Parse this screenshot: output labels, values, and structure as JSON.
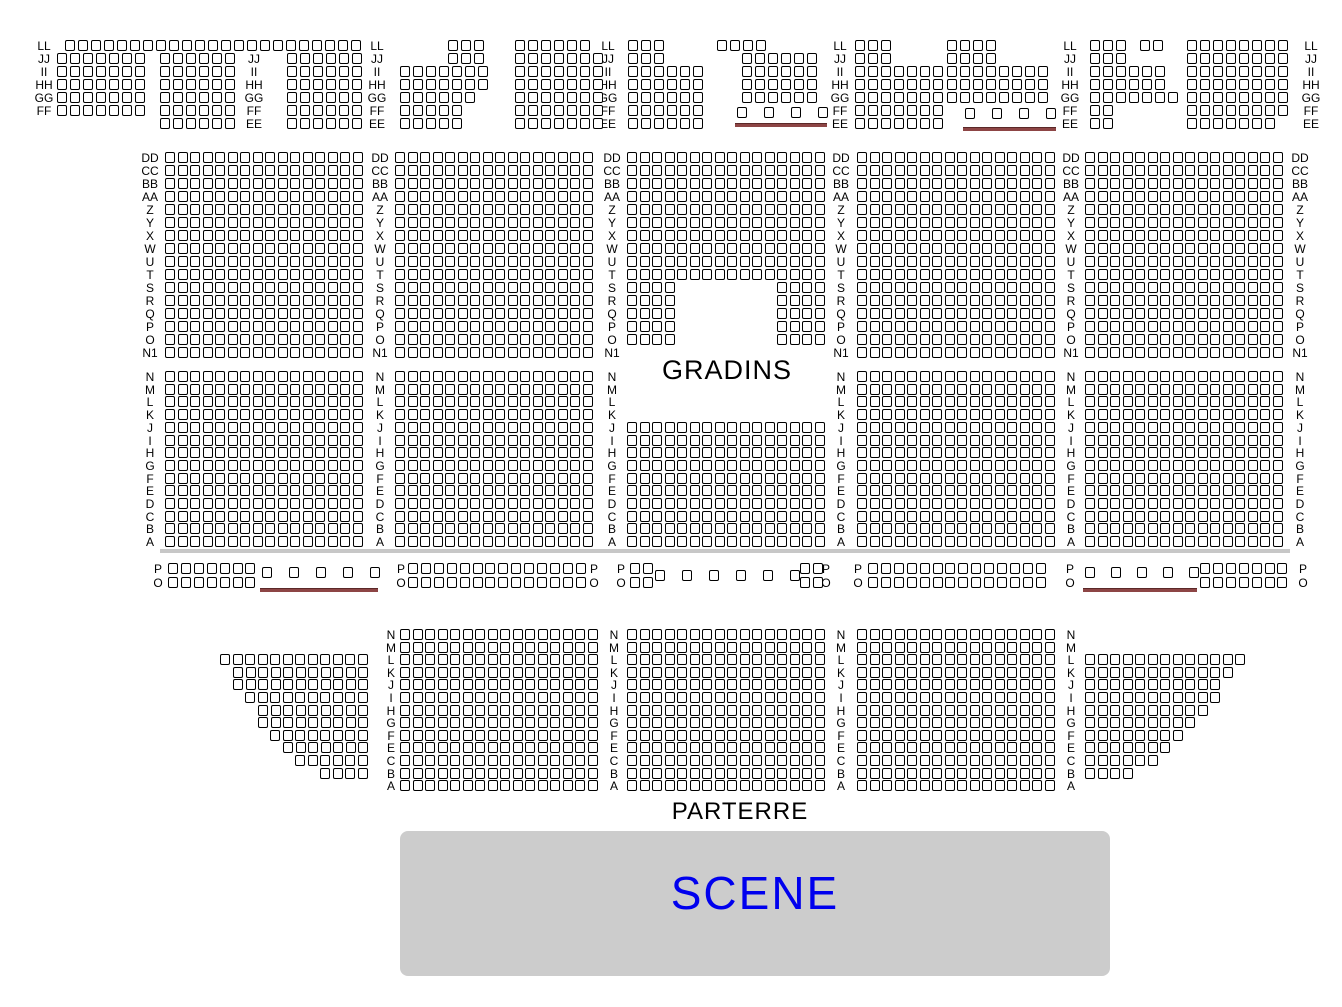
{
  "texts": {
    "gradins": "GRADINS",
    "parterre": "PARTERRE",
    "scene": "SCENE"
  },
  "colors": {
    "background": "#ffffff",
    "seat_fill": "#ffffff",
    "seat_border": "#000000",
    "row_label": "#000000",
    "zone_text": "#000000",
    "wheelchair_bar": "#8d4545",
    "wheelchair_bar_edge": "#5a2828",
    "aisle_bar": "#c7c7c7",
    "stage_fill": "#cccccc",
    "stage_text": "#0000ee"
  },
  "seatmap": {
    "aisle": {
      "x": 160,
      "y": 549,
      "w": 1130,
      "h": 4
    },
    "sections": [
      {
        "name": "balcony",
        "y0": 40,
        "pitchX": 13,
        "pitchY": 13,
        "rowLabels": [
          "LL",
          "JJ",
          "II",
          "HH",
          "GG",
          "FF",
          "EE"
        ],
        "labelCols": [
          {
            "x": 44,
            "from": 0,
            "to": 5
          },
          {
            "x": 254,
            "from": 1,
            "to": 6
          },
          {
            "x": 377,
            "from": 0,
            "to": 6
          },
          {
            "x": 608,
            "from": 0,
            "to": 6
          },
          {
            "x": 840,
            "from": 0,
            "to": 6
          },
          {
            "x": 1070,
            "from": 0,
            "to": 6
          },
          {
            "x": 1311,
            "from": 0,
            "to": 6
          }
        ],
        "runs": [
          [
            0,
            65,
            23
          ],
          [
            0,
            448,
            3
          ],
          [
            0,
            515,
            6
          ],
          [
            0,
            628,
            3
          ],
          [
            0,
            717,
            4
          ],
          [
            0,
            855,
            3
          ],
          [
            0,
            947,
            4
          ],
          [
            0,
            1090,
            3
          ],
          [
            0,
            1140,
            2
          ],
          [
            0,
            1187,
            8
          ],
          [
            1,
            57,
            7
          ],
          [
            2,
            57,
            7
          ],
          [
            3,
            57,
            7
          ],
          [
            4,
            57,
            7
          ],
          [
            5,
            57,
            7
          ],
          [
            1,
            160,
            6
          ],
          [
            2,
            160,
            6
          ],
          [
            3,
            160,
            6
          ],
          [
            4,
            160,
            6
          ],
          [
            5,
            160,
            6
          ],
          [
            6,
            160,
            6
          ],
          [
            1,
            287,
            6
          ],
          [
            2,
            287,
            6
          ],
          [
            3,
            287,
            6
          ],
          [
            4,
            287,
            6
          ],
          [
            5,
            287,
            6
          ],
          [
            6,
            287,
            6
          ],
          [
            1,
            448,
            3
          ],
          [
            2,
            400,
            7
          ],
          [
            3,
            400,
            7
          ],
          [
            4,
            400,
            6
          ],
          [
            5,
            400,
            5
          ],
          [
            6,
            400,
            5
          ],
          [
            1,
            515,
            7
          ],
          [
            2,
            515,
            7
          ],
          [
            3,
            515,
            7
          ],
          [
            4,
            515,
            7
          ],
          [
            5,
            515,
            7
          ],
          [
            6,
            515,
            7
          ],
          [
            1,
            628,
            3
          ],
          [
            2,
            628,
            6
          ],
          [
            3,
            628,
            6
          ],
          [
            4,
            628,
            6
          ],
          [
            5,
            628,
            6
          ],
          [
            6,
            628,
            6
          ],
          [
            1,
            742,
            6
          ],
          [
            2,
            742,
            6
          ],
          [
            3,
            742,
            6
          ],
          [
            4,
            742,
            6
          ],
          [
            1,
            855,
            3
          ],
          [
            2,
            855,
            7
          ],
          [
            3,
            855,
            7
          ],
          [
            4,
            855,
            7
          ],
          [
            5,
            855,
            7
          ],
          [
            6,
            855,
            7
          ],
          [
            1,
            947,
            4
          ],
          [
            2,
            947,
            8
          ],
          [
            3,
            947,
            8
          ],
          [
            4,
            947,
            8
          ],
          [
            1,
            1090,
            3
          ],
          [
            2,
            1090,
            6
          ],
          [
            3,
            1090,
            6
          ],
          [
            4,
            1090,
            7
          ],
          [
            5,
            1090,
            2
          ],
          [
            6,
            1090,
            2
          ],
          [
            1,
            1187,
            8
          ],
          [
            2,
            1187,
            8
          ],
          [
            3,
            1187,
            8
          ],
          [
            4,
            1187,
            8
          ],
          [
            5,
            1187,
            8
          ],
          [
            6,
            1187,
            7
          ]
        ],
        "singles": [
          [
            737,
            107
          ],
          [
            764,
            107
          ],
          [
            791,
            107
          ],
          [
            818,
            107
          ],
          [
            965,
            108
          ],
          [
            992,
            108
          ],
          [
            1019,
            108
          ],
          [
            1046,
            108
          ]
        ],
        "bars": [
          [
            735,
            123,
            92
          ],
          [
            963,
            127,
            93
          ]
        ]
      },
      {
        "name": "gradins-upper",
        "y0": 152,
        "pitchX": 12.5,
        "pitchY": 13,
        "rowLabels": [
          "DD",
          "CC",
          "BB",
          "AA",
          "Z",
          "Y",
          "X",
          "W",
          "U",
          "T",
          "S",
          "R",
          "Q",
          "P",
          "O",
          "N1"
        ],
        "labelCols": [
          {
            "x": 150,
            "from": 0,
            "to": 15
          },
          {
            "x": 380,
            "from": 0,
            "to": 15
          },
          {
            "x": 612,
            "from": 0,
            "to": 15
          },
          {
            "x": 841,
            "from": 0,
            "to": 15
          },
          {
            "x": 1071,
            "from": 0,
            "to": 15
          },
          {
            "x": 1300,
            "from": 0,
            "to": 15
          }
        ],
        "blocks": [
          {
            "x": 165,
            "row0": 0,
            "nrows": 16,
            "ncols": 16
          },
          {
            "x": 395,
            "row0": 0,
            "nrows": 16,
            "ncols": 16
          },
          {
            "x": 857,
            "row0": 0,
            "nrows": 16,
            "ncols": 16
          },
          {
            "x": 1085,
            "row0": 0,
            "nrows": 16,
            "ncols": 16
          }
        ],
        "runs": [
          [
            0,
            627,
            16
          ],
          [
            1,
            627,
            16
          ],
          [
            2,
            627,
            16
          ],
          [
            3,
            627,
            16
          ],
          [
            4,
            627,
            16
          ],
          [
            5,
            627,
            16
          ],
          [
            6,
            627,
            16
          ],
          [
            7,
            627,
            16
          ],
          [
            8,
            627,
            16
          ],
          [
            9,
            627,
            16
          ],
          [
            10,
            627,
            4
          ],
          [
            10,
            777,
            4
          ],
          [
            11,
            627,
            4
          ],
          [
            11,
            777,
            4
          ],
          [
            12,
            627,
            4
          ],
          [
            12,
            777,
            4
          ],
          [
            13,
            627,
            4
          ],
          [
            13,
            777,
            4
          ],
          [
            14,
            627,
            4
          ],
          [
            14,
            777,
            4
          ]
        ]
      },
      {
        "name": "gradins-lower",
        "y0": 371,
        "pitchX": 12.5,
        "pitchY": 12.7,
        "rowLabels": [
          "N",
          "M",
          "L",
          "K",
          "J",
          "I",
          "H",
          "G",
          "F",
          "E",
          "D",
          "C",
          "B",
          "A"
        ],
        "labelCols": [
          {
            "x": 150,
            "from": 0,
            "to": 13
          },
          {
            "x": 380,
            "from": 0,
            "to": 13
          },
          {
            "x": 612,
            "from": 0,
            "to": 13
          },
          {
            "x": 841,
            "from": 0,
            "to": 13
          },
          {
            "x": 1071,
            "from": 0,
            "to": 13
          },
          {
            "x": 1300,
            "from": 0,
            "to": 13
          }
        ],
        "blocks": [
          {
            "x": 165,
            "row0": 0,
            "nrows": 14,
            "ncols": 16
          },
          {
            "x": 395,
            "row0": 0,
            "nrows": 14,
            "ncols": 16
          },
          {
            "x": 627,
            "row0": 4,
            "nrows": 10,
            "ncols": 16
          },
          {
            "x": 857,
            "row0": 0,
            "nrows": 14,
            "ncols": 16
          },
          {
            "x": 1085,
            "row0": 0,
            "nrows": 14,
            "ncols": 16
          }
        ]
      },
      {
        "name": "orchestra-po",
        "y0": 563,
        "pitchX": 12.9,
        "pitchY": 13.5,
        "rowLabels": [
          "P",
          "O"
        ],
        "labelCols": [
          {
            "x": 158,
            "from": 0,
            "to": 1
          },
          {
            "x": 401,
            "from": 0,
            "to": 1
          },
          {
            "x": 594,
            "from": 0,
            "to": 1
          },
          {
            "x": 621,
            "from": 0,
            "to": 1
          },
          {
            "x": 826,
            "from": 0,
            "to": 1
          },
          {
            "x": 858,
            "from": 0,
            "to": 1
          },
          {
            "x": 1070,
            "from": 0,
            "to": 1
          },
          {
            "x": 1303,
            "from": 0,
            "to": 1
          }
        ],
        "runs": [
          [
            0,
            168,
            7
          ],
          [
            1,
            168,
            7
          ],
          [
            0,
            408,
            14
          ],
          [
            1,
            408,
            14
          ],
          [
            0,
            630,
            2
          ],
          [
            1,
            630,
            2
          ],
          [
            0,
            800,
            2
          ],
          [
            1,
            800,
            2
          ],
          [
            0,
            868,
            14
          ],
          [
            1,
            868,
            14
          ],
          [
            0,
            1200,
            7
          ],
          [
            1,
            1200,
            7
          ]
        ],
        "singles": [
          [
            262,
            567
          ],
          [
            289,
            567
          ],
          [
            316,
            567
          ],
          [
            343,
            567
          ],
          [
            370,
            567
          ],
          [
            655,
            570
          ],
          [
            682,
            570
          ],
          [
            709,
            570
          ],
          [
            736,
            570
          ],
          [
            763,
            570
          ],
          [
            790,
            570
          ],
          [
            1085,
            567
          ],
          [
            1111,
            567
          ],
          [
            1137,
            567
          ],
          [
            1163,
            567
          ],
          [
            1189,
            567
          ]
        ],
        "bars": [
          [
            260,
            588,
            118
          ],
          [
            1083,
            588,
            114
          ]
        ]
      },
      {
        "name": "parterre",
        "y0": 629,
        "pitchX": 12.5,
        "pitchY": 12.6,
        "rowLabels": [
          "N",
          "M",
          "L",
          "K",
          "J",
          "I",
          "H",
          "G",
          "F",
          "E",
          "C",
          "B",
          "A"
        ],
        "labelCols": [
          {
            "x": 391,
            "from": 0,
            "to": 12
          },
          {
            "x": 614,
            "from": 0,
            "to": 12
          },
          {
            "x": 841,
            "from": 0,
            "to": 12
          },
          {
            "x": 1071,
            "from": 0,
            "to": 12
          }
        ],
        "blocks": [
          {
            "x": 400,
            "row0": 0,
            "nrows": 13,
            "ncols": 16
          },
          {
            "x": 627,
            "row0": 0,
            "nrows": 13,
            "ncols": 16
          },
          {
            "x": 857,
            "row0": 0,
            "nrows": 13,
            "ncols": 16
          }
        ],
        "runs": [
          [
            2,
            220,
            12
          ],
          [
            3,
            233,
            11
          ],
          [
            4,
            233,
            11
          ],
          [
            5,
            245,
            10
          ],
          [
            6,
            258,
            9
          ],
          [
            7,
            258,
            9
          ],
          [
            8,
            270,
            8
          ],
          [
            9,
            283,
            7
          ],
          [
            10,
            295,
            6
          ],
          [
            11,
            320,
            4
          ],
          [
            2,
            1085,
            13
          ],
          [
            3,
            1085,
            12
          ],
          [
            4,
            1085,
            11
          ],
          [
            5,
            1085,
            11
          ],
          [
            6,
            1085,
            10
          ],
          [
            7,
            1085,
            9
          ],
          [
            8,
            1085,
            8
          ],
          [
            9,
            1085,
            7
          ],
          [
            10,
            1085,
            6
          ],
          [
            11,
            1085,
            4
          ]
        ]
      }
    ]
  }
}
